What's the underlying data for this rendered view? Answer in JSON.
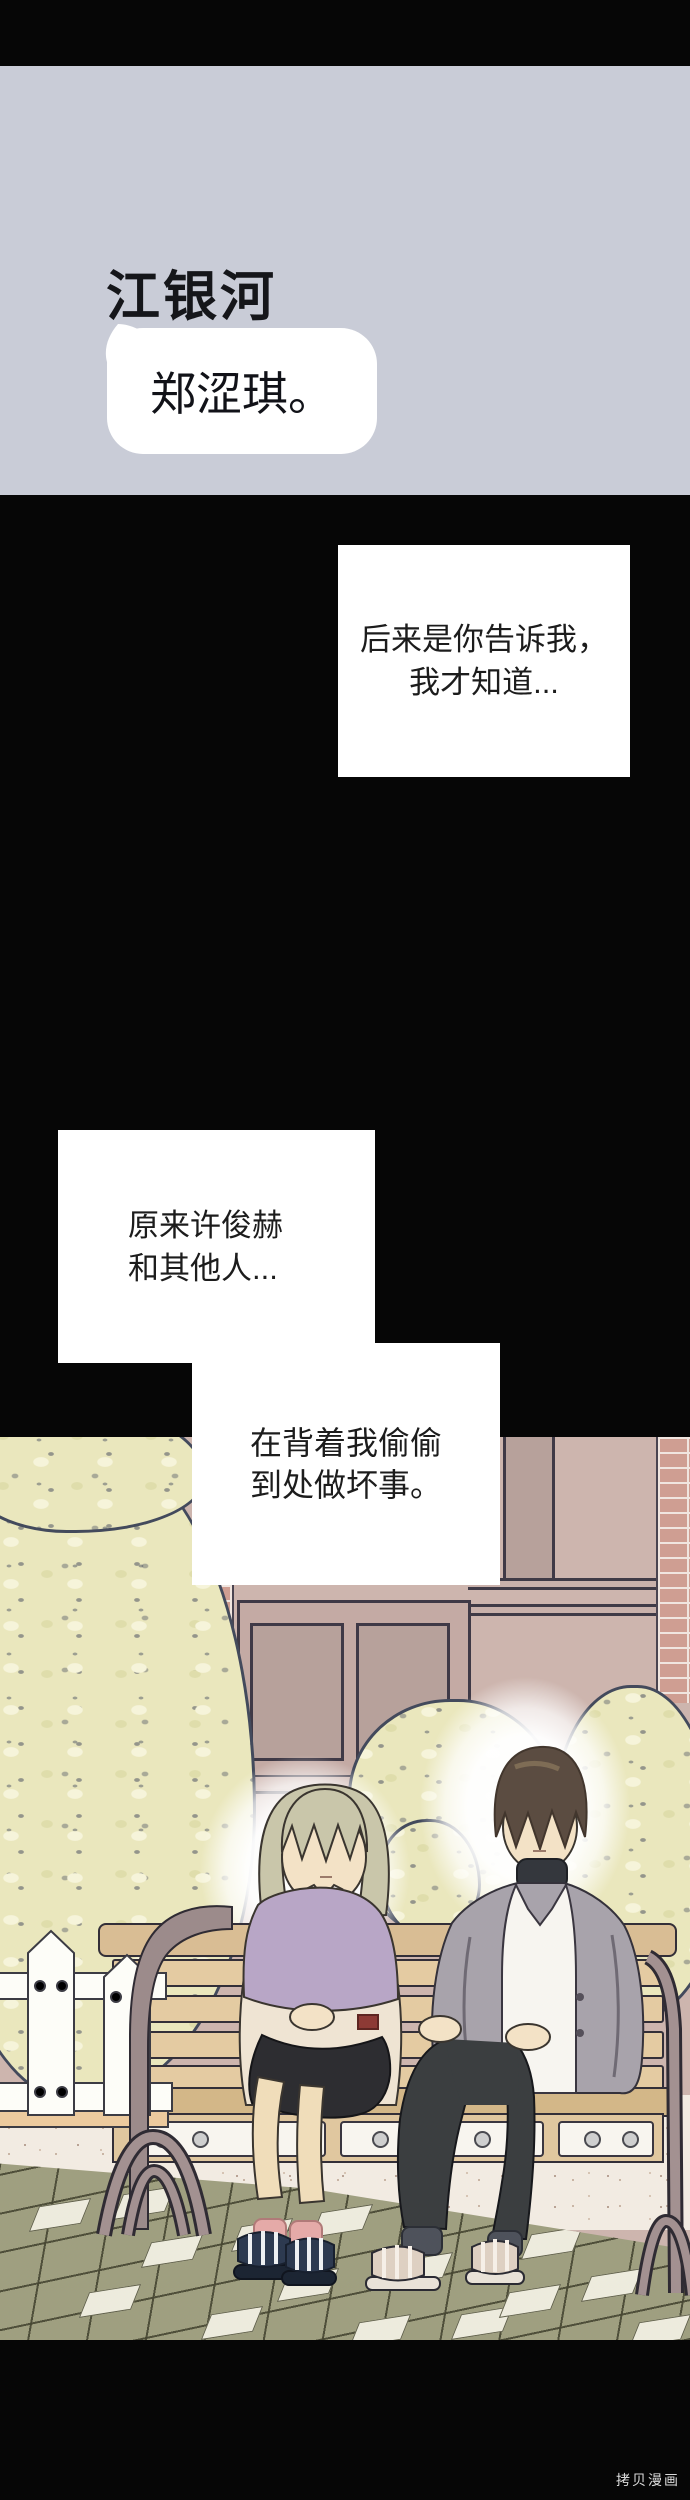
{
  "chat": {
    "contact_name": "江银河",
    "message": "郑涩琪。"
  },
  "captions": [
    {
      "lines": [
        "后来是你告诉我，",
        "我才知道..."
      ]
    },
    {
      "lines": [
        "原来许俊赫",
        "和其他人..."
      ]
    },
    {
      "lines": [
        "在背着我偷偷",
        "到处做坏事。"
      ]
    }
  ],
  "watermark": {
    "text": "拷贝漫画"
  },
  "colors": {
    "chat_background": "#c9ccd7",
    "bubble": "#ffffff",
    "page_black": "#060606",
    "caption_background": "#ffffff",
    "wall": "#cdb5ae",
    "brick": "#cf9e92",
    "window_pane": "#b7a19b",
    "foliage": "#eae7bd",
    "foliage_outline": "#434a5c",
    "bench_wood": "#d9bd94",
    "bench_metal": "#9c8b8b",
    "fence_white": "#fdfdf8",
    "pavement_olive": "#9f9f80",
    "pavement_white": "#edebdd",
    "ground_speckle": "#f2ebe2",
    "girl_hair": "#c9c6aa",
    "girl_hoodie_top": "#b8a6c6",
    "girl_hoodie_bottom": "#efe4d3",
    "girl_skirt": "#2d2d31",
    "girl_socks": "#e5aaa8",
    "girl_sandals": "#2d3a50",
    "boy_hair": "#5b4c41",
    "boy_cardigan": "#a8a3ab",
    "boy_shirt": "#f7f5f0",
    "boy_pants": "#3b3e40",
    "skin": "#f3e2c6"
  }
}
